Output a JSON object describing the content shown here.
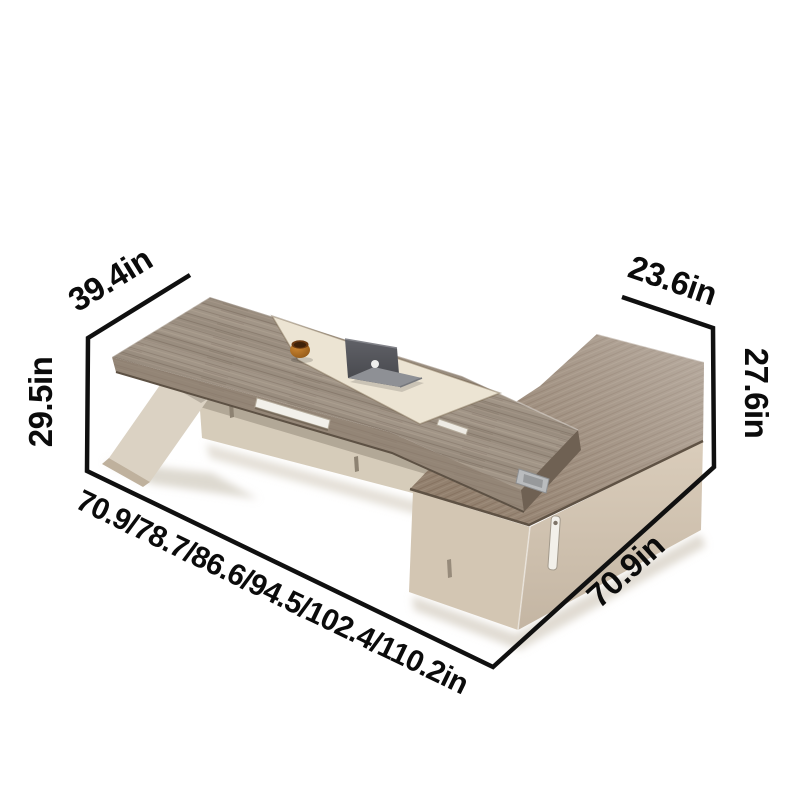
{
  "page": {
    "background_color": "#ffffff"
  },
  "diagram": {
    "subject": "l-shaped-executive-desk-dimension-diagram",
    "line_color": "#101010",
    "label_color": "#0b0b0b",
    "colors": {
      "desk_top_wood": "#9e9183",
      "desk_edge_wood": "#8d7e6f",
      "desk_end_cap": "#6f6153",
      "inlay": "#ece4d3",
      "return_top_wood": "#92806e",
      "cabinet_left_face": "#d3c6b3",
      "cabinet_right_face": "#dacdbb",
      "leg": "#dbd2c3",
      "leg_side": "#bfb19d",
      "modesty_panel": "#d6ccba",
      "handle": "#f2f0ea",
      "bracket_metal": "#babcbe",
      "cup": "#b4701f",
      "laptop": "#55565b"
    },
    "dimensions": {
      "desk_depth": "39.4in",
      "desk_height": "29.5in",
      "desk_length_options": "70.9/78.7/86.6/94.5/102.4/110.2in",
      "return_length": "70.9in",
      "return_depth": "23.6in",
      "return_height": "27.6in"
    }
  }
}
